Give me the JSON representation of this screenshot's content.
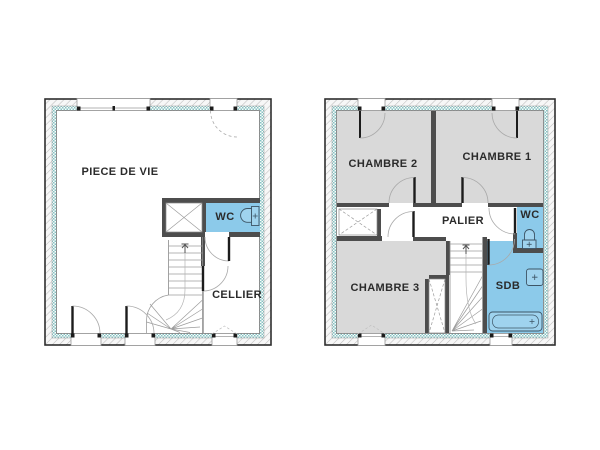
{
  "plans": [
    {
      "id": "ground-floor",
      "rooms": [
        {
          "id": "piece-de-vie",
          "label": "PIECE DE VIE"
        },
        {
          "id": "wc",
          "label": "WC"
        },
        {
          "id": "cellier",
          "label": "CELLIER"
        }
      ],
      "fixtures": [
        "toilet-icon",
        "stairs-icon",
        "closet-icon"
      ]
    },
    {
      "id": "first-floor",
      "rooms": [
        {
          "id": "chambre-2",
          "label": "CHAMBRE 2"
        },
        {
          "id": "chambre-1",
          "label": "CHAMBRE 1"
        },
        {
          "id": "palier",
          "label": "PALIER"
        },
        {
          "id": "wc",
          "label": "WC"
        },
        {
          "id": "chambre-3",
          "label": "CHAMBRE 3"
        },
        {
          "id": "sdb",
          "label": "SDB"
        }
      ],
      "fixtures": [
        "toilet-icon",
        "sink-icon",
        "bathtub-icon",
        "stairs-icon",
        "closet-icon"
      ]
    }
  ],
  "colors": {
    "wet_room_fill": "#8ccaea",
    "room_fill": "#d9d9d9",
    "wall": "#4d4d4d",
    "insulation": "#85c2c2",
    "fixture_fill": "#9fd3ee",
    "fixture_stroke": "#3d5566",
    "text": "#2b2b2b",
    "background": "#ffffff"
  }
}
